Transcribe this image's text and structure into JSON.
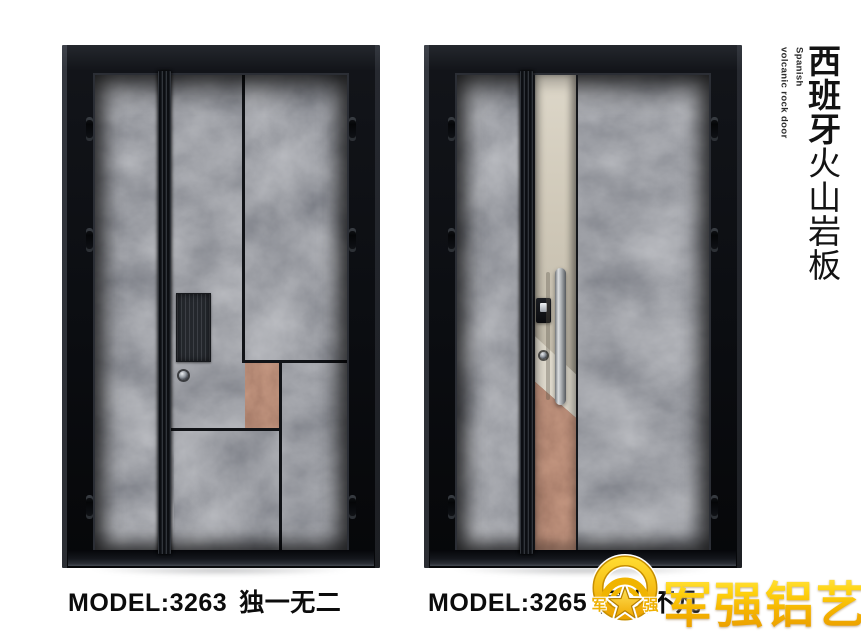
{
  "side_panel": {
    "title_bold": "西班牙",
    "title_regular": "火山岩板",
    "subtitle_line1": "Spanish",
    "subtitle_line2": "volcanic rock door"
  },
  "doors": [
    {
      "model": "MODEL:3263",
      "name": "独一无二"
    },
    {
      "model": "MODEL:3265",
      "name": "层山不凡"
    }
  ],
  "logo": {
    "brand": "军强铝艺",
    "emblem_left": "军",
    "emblem_right": "强"
  },
  "colors": {
    "gold": "#f5b800",
    "rock_gray": "#53575e",
    "rust": "#7a4430",
    "champagne": "#cfc8b8",
    "frame_black": "#121419",
    "text_black": "#0c0c0c"
  }
}
